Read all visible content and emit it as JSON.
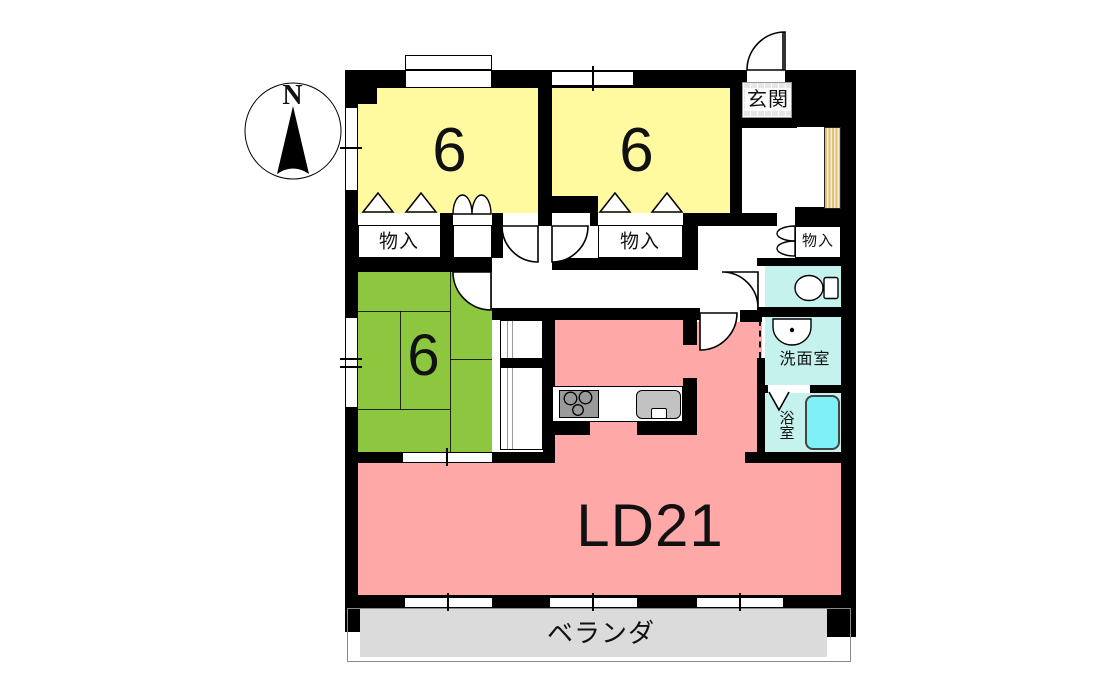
{
  "compass": {
    "north_label": "N"
  },
  "rooms": {
    "bedroom_a": {
      "label": "6",
      "color": "#FFF9A0"
    },
    "bedroom_b": {
      "label": "6",
      "color": "#FFF9A0"
    },
    "japanese_room": {
      "label": "6",
      "color": "#8DC73F"
    },
    "living_dining": {
      "label": "LD21",
      "color": "#FFA8A8"
    },
    "entrance": {
      "label": "玄関",
      "color": "#E6E6E6"
    },
    "storage_a": {
      "label": "物入"
    },
    "storage_b": {
      "label": "物入"
    },
    "storage_c": {
      "label": "物入"
    },
    "washroom": {
      "label": "洗面室",
      "color": "#C6F2EE"
    },
    "bathroom": {
      "label": "浴室",
      "color": "#C6F2EE"
    },
    "veranda": {
      "label": "ベランダ",
      "color": "#DBDBDB"
    }
  },
  "colors": {
    "wall": "#000000",
    "bathtub": "#7FF0F5",
    "shoe_cabinet_stripe": "#DEC27A",
    "kitchen_counter": "#9A9A9A"
  }
}
